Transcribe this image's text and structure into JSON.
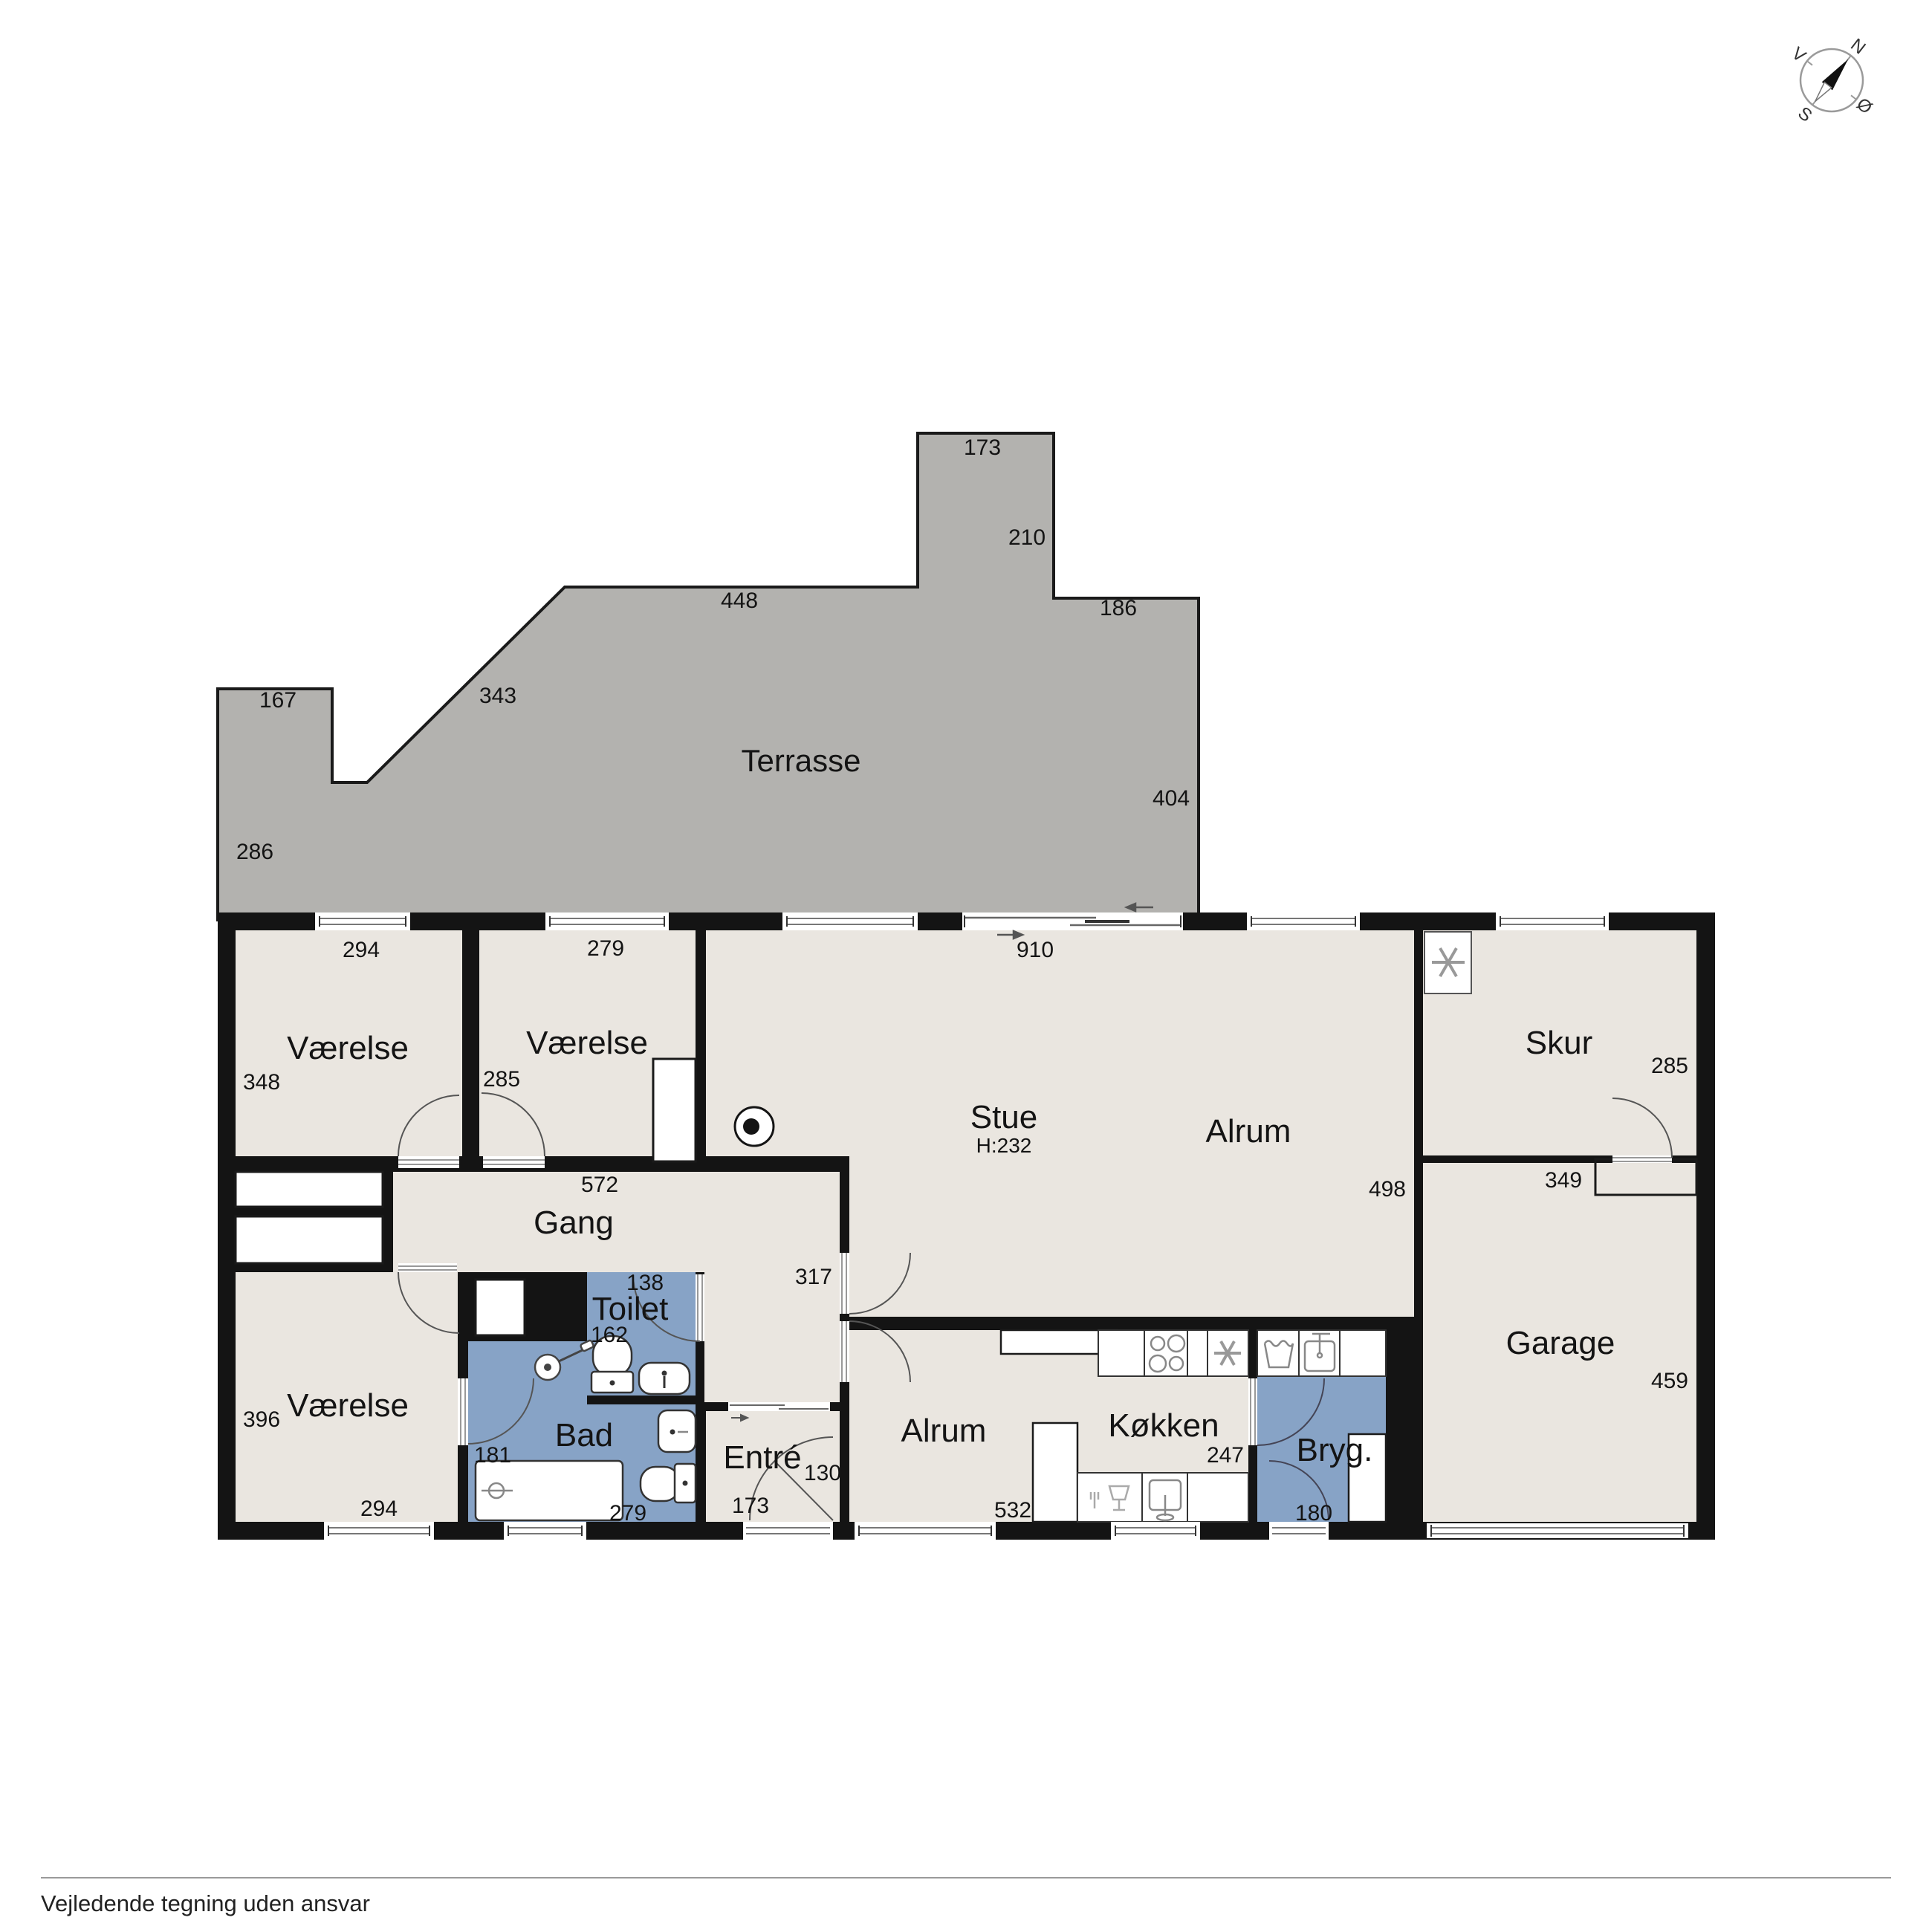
{
  "disclaimer": "Vejledende tegning uden ansvar",
  "compass": {
    "north": "N",
    "south": "S",
    "east": "Ø",
    "west": "V"
  },
  "terrace": {
    "label": "Terrasse",
    "dim_bump_top": "173",
    "dim_bump_right": "210",
    "dim_mid_top": "448",
    "dim_step_top": "186",
    "dim_left_top": "167",
    "dim_diagonal": "343",
    "dim_right": "404",
    "dim_left": "286"
  },
  "rooms": {
    "vaerelse_nw": {
      "label": "Værelse",
      "dim_top": "294",
      "dim_left": "348"
    },
    "vaerelse_n": {
      "label": "Værelse",
      "dim_top": "279",
      "dim_left": "285"
    },
    "stue": {
      "label": "Stue",
      "height": "H:232",
      "dim_top": "910"
    },
    "alrum_upper": {
      "label": "Alrum",
      "dim_right": "498"
    },
    "skur": {
      "label": "Skur",
      "dim_right": "285",
      "dim_bottom": "349"
    },
    "gang": {
      "label": "Gang",
      "dim_top": "572",
      "dim_door": "317"
    },
    "toilet": {
      "label": "Toilet",
      "dim_top": "138",
      "dim_left": "162"
    },
    "bad": {
      "label": "Bad",
      "dim_door": "181",
      "dim_bottom": "279"
    },
    "vaerelse_sw": {
      "label": "Værelse",
      "dim_left": "396",
      "dim_bottom": "294"
    },
    "entre": {
      "label": "Entré",
      "dim_right": "130",
      "dim_bottom": "173"
    },
    "alrum_lower": {
      "label": "Alrum",
      "dim_bottom": "532"
    },
    "koekken": {
      "label": "Køkken",
      "dim_right": "247"
    },
    "bryggers": {
      "label": "Bryg.",
      "dim_door": "180"
    },
    "garage": {
      "label": "Garage",
      "dim_right": "459"
    }
  },
  "colors": {
    "floor": "#eae6e0",
    "wet": "#87a3c6",
    "terrace": "#b3b2af",
    "wall": "#141414"
  }
}
